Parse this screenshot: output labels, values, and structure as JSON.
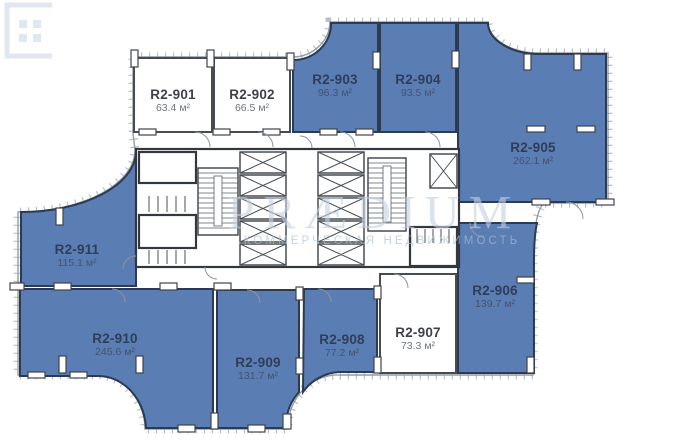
{
  "palette": {
    "unit_highlight": "#5a7db4",
    "unit_plain": "#ffffff",
    "wall": "#3a4047",
    "facade_tick": "#b7bec7"
  },
  "watermark": {
    "brand": "PRÆDIUM",
    "tagline": "КОММЕРЧЕСКАЯ НЕДВИЖИМОСТЬ"
  },
  "units": [
    {
      "id": "R2-901",
      "name": "R2-901",
      "area": "63.4 м²",
      "highlighted": false
    },
    {
      "id": "R2-902",
      "name": "R2-902",
      "area": "66.5 м²",
      "highlighted": false
    },
    {
      "id": "R2-903",
      "name": "R2-903",
      "area": "96.3 м²",
      "highlighted": true
    },
    {
      "id": "R2-904",
      "name": "R2-904",
      "area": "93.5 м²",
      "highlighted": true
    },
    {
      "id": "R2-905",
      "name": "R2-905",
      "area": "262.1 м²",
      "highlighted": true
    },
    {
      "id": "R2-906",
      "name": "R2-906",
      "area": "139.7 м²",
      "highlighted": true
    },
    {
      "id": "R2-907",
      "name": "R2-907",
      "area": "73.3 м²",
      "highlighted": false
    },
    {
      "id": "R2-908",
      "name": "R2-908",
      "area": "77.2 м²",
      "highlighted": true
    },
    {
      "id": "R2-909",
      "name": "R2-909",
      "area": "131.7 м²",
      "highlighted": true
    },
    {
      "id": "R2-910",
      "name": "R2-910",
      "area": "245.6 м²",
      "highlighted": true
    },
    {
      "id": "R2-911",
      "name": "R2-911",
      "area": "115.1 м²",
      "highlighted": true
    }
  ]
}
